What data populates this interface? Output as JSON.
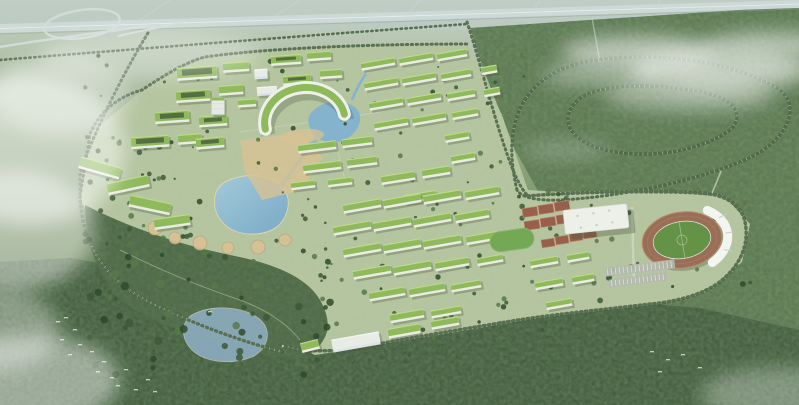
{
  "meta": {
    "image_type": "aerial architectural rendering",
    "scene": "bird's-eye master plan of a green university campus with green-roof building clusters, lakes and canal, a stadium with running track, gymnasium, tennis courts, an elevated highway with interchange at top, tree-lined loop roads in surrounding forest, mist and flying birds"
  },
  "palette": {
    "haze_top": "#c6d2c8",
    "plain": "#a9bba0",
    "forest_dark": "#415a3a",
    "forest_mid": "#6f8c60",
    "park": "#4c6742",
    "campus_ground": "#b5c3a0",
    "road": "#cfd8c4",
    "highway": "#ccd9d7",
    "highway_median": "#eaf1ee",
    "tree_dark": "#3d5837",
    "tree_mid": "#567849",
    "roof_green": "#8fba5c",
    "roof_light": "#c5dd90",
    "facade": "#eaece1",
    "facade_shadow": "#4a5a3e",
    "courtyard": "#49603c",
    "white_glass": "#dce4e6",
    "water": "#83b3cd",
    "water_light": "#a3c9dc",
    "pond": "#8aa9ba",
    "plaza_tan": "#d8c294",
    "court_red": "#96604c",
    "lawn": "#74a854",
    "track": "#9a6f58",
    "pitch": "#649348",
    "stand_white": "#f3f5f0",
    "gym_roof": "#edefe9",
    "parking": "#b4b9ae",
    "cloud": "#ffffff"
  },
  "buildings": {
    "slabs": [
      [
        197,
        73,
        40,
        13,
        -4,
        "gc"
      ],
      [
        236,
        67,
        26,
        10,
        -4,
        "g"
      ],
      [
        193,
        96,
        34,
        12,
        -4,
        "gc"
      ],
      [
        231,
        90,
        24,
        10,
        -4,
        "g"
      ],
      [
        172,
        117,
        34,
        12,
        -4,
        "gc"
      ],
      [
        213,
        121,
        28,
        11,
        -4,
        "gc"
      ],
      [
        218,
        106,
        13,
        17,
        0,
        "t"
      ],
      [
        247,
        103,
        18,
        8,
        -4,
        "g"
      ],
      [
        286,
        60,
        30,
        10,
        -4,
        "gc"
      ],
      [
        319,
        56,
        24,
        9,
        -4,
        "g"
      ],
      [
        297,
        80,
        28,
        10,
        -4,
        "gc"
      ],
      [
        331,
        74,
        22,
        9,
        -4,
        "g"
      ],
      [
        267,
        91,
        20,
        9,
        -4,
        "w"
      ],
      [
        261,
        74,
        13,
        10,
        -3,
        "w"
      ],
      [
        378,
        64,
        34,
        8,
        -10,
        "g"
      ],
      [
        416,
        59,
        34,
        8,
        -10,
        "g"
      ],
      [
        452,
        55,
        30,
        8,
        -10,
        "g"
      ],
      [
        381,
        84,
        34,
        8,
        -10,
        "g"
      ],
      [
        419,
        79,
        34,
        8,
        -10,
        "g"
      ],
      [
        456,
        75,
        30,
        8,
        -10,
        "g"
      ],
      [
        386,
        104,
        34,
        8,
        -10,
        "g"
      ],
      [
        424,
        99,
        34,
        8,
        -10,
        "g"
      ],
      [
        461,
        95,
        28,
        8,
        -10,
        "g"
      ],
      [
        391,
        124,
        34,
        8,
        -10,
        "g"
      ],
      [
        429,
        119,
        34,
        8,
        -10,
        "g"
      ],
      [
        465,
        114,
        26,
        8,
        -10,
        "g"
      ],
      [
        489,
        70,
        16,
        8,
        -10,
        "g"
      ],
      [
        492,
        92,
        16,
        8,
        -10,
        "g"
      ],
      [
        457,
        137,
        24,
        8,
        -10,
        "g"
      ],
      [
        463,
        158,
        24,
        8,
        -10,
        "g"
      ],
      [
        317,
        147,
        38,
        9,
        -7,
        "g"
      ],
      [
        357,
        142,
        30,
        9,
        -7,
        "g"
      ],
      [
        322,
        167,
        38,
        9,
        -7,
        "g"
      ],
      [
        362,
        162,
        30,
        9,
        -7,
        "g"
      ],
      [
        303,
        185,
        24,
        8,
        -7,
        "g"
      ],
      [
        340,
        182,
        24,
        8,
        -7,
        "g"
      ],
      [
        398,
        178,
        34,
        9,
        -9,
        "g"
      ],
      [
        436,
        172,
        28,
        9,
        -9,
        "g"
      ],
      [
        420,
        197,
        32,
        9,
        -9,
        "g"
      ],
      [
        100,
        168,
        42,
        12,
        16,
        "g"
      ],
      [
        128,
        185,
        42,
        12,
        -12,
        "g"
      ],
      [
        150,
        205,
        42,
        12,
        12,
        "g"
      ],
      [
        172,
        222,
        36,
        11,
        -8,
        "g"
      ],
      [
        150,
        142,
        38,
        12,
        -4,
        "gc"
      ],
      [
        190,
        139,
        24,
        10,
        -4,
        "g"
      ],
      [
        210,
        143,
        28,
        11,
        -5,
        "gc"
      ],
      [
        362,
        206,
        38,
        9,
        -10,
        "g"
      ],
      [
        402,
        201,
        38,
        9,
        -10,
        "g"
      ],
      [
        442,
        197,
        38,
        9,
        -10,
        "g"
      ],
      [
        482,
        193,
        34,
        9,
        -10,
        "g"
      ],
      [
        352,
        228,
        38,
        9,
        -10,
        "g"
      ],
      [
        392,
        224,
        38,
        9,
        -10,
        "g"
      ],
      [
        432,
        220,
        38,
        9,
        -10,
        "g"
      ],
      [
        472,
        216,
        34,
        9,
        -10,
        "g"
      ],
      [
        362,
        250,
        38,
        9,
        -10,
        "g"
      ],
      [
        402,
        246,
        38,
        9,
        -10,
        "g"
      ],
      [
        442,
        242,
        38,
        9,
        -10,
        "g"
      ],
      [
        482,
        238,
        32,
        9,
        -10,
        "g"
      ],
      [
        372,
        272,
        38,
        9,
        -10,
        "g"
      ],
      [
        412,
        268,
        38,
        9,
        -10,
        "g"
      ],
      [
        452,
        264,
        34,
        9,
        -10,
        "g"
      ],
      [
        490,
        260,
        26,
        8,
        -10,
        "g"
      ],
      [
        387,
        294,
        36,
        9,
        -10,
        "g"
      ],
      [
        427,
        290,
        36,
        9,
        -10,
        "g"
      ],
      [
        466,
        286,
        30,
        8,
        -10,
        "g"
      ],
      [
        407,
        316,
        34,
        9,
        -10,
        "g"
      ],
      [
        446,
        312,
        30,
        8,
        -10,
        "g"
      ],
      [
        544,
        262,
        28,
        8,
        -10,
        "g"
      ],
      [
        578,
        257,
        22,
        8,
        -10,
        "g"
      ],
      [
        549,
        284,
        28,
        8,
        -10,
        "g"
      ],
      [
        583,
        279,
        22,
        8,
        -10,
        "g"
      ],
      [
        559,
        304,
        26,
        8,
        -10,
        "g"
      ],
      [
        356,
        342,
        48,
        13,
        -10,
        "w"
      ],
      [
        404,
        331,
        32,
        10,
        -10,
        "g"
      ],
      [
        445,
        323,
        28,
        9,
        -10,
        "g"
      ],
      [
        310,
        346,
        18,
        10,
        -14,
        "g"
      ]
    ]
  },
  "sports": {
    "courts_group1": {
      "rot": -8,
      "cell_w": 15,
      "cell_h": 9,
      "cells": [
        [
          530,
          212
        ],
        [
          546,
          209
        ],
        [
          562,
          206
        ],
        [
          532,
          225
        ],
        [
          548,
          222
        ],
        [
          564,
          219
        ]
      ]
    },
    "courts_group2": {
      "rot": -8,
      "cell_w": 13,
      "cell_h": 8,
      "cells": [
        [
          548,
          243
        ],
        [
          562,
          240
        ],
        [
          576,
          237
        ],
        [
          590,
          234
        ]
      ]
    },
    "parking_rows": [
      [
        640,
        268,
        70,
        9,
        -7
      ],
      [
        638,
        280,
        58,
        8,
        -7
      ]
    ]
  },
  "plaza_circles": [
    [
      155,
      228,
      7
    ],
    [
      175,
      238,
      6
    ],
    [
      200,
      243,
      7
    ],
    [
      228,
      248,
      6
    ],
    [
      258,
      247,
      7
    ],
    [
      285,
      240,
      6
    ]
  ],
  "trees": {
    "seed": 7,
    "colors": [
      "#3d5837",
      "#567849",
      "#2f4a2c"
    ],
    "regions": [
      {
        "x": 85,
        "y": 45,
        "w": 440,
        "h": 150,
        "n": 60,
        "rmin": 1,
        "rmax": 2.6
      },
      {
        "x": 300,
        "y": 190,
        "w": 260,
        "h": 150,
        "n": 55,
        "rmin": 1.2,
        "rmax": 2.8
      },
      {
        "x": 88,
        "y": 235,
        "w": 250,
        "h": 140,
        "n": 70,
        "rmin": 2,
        "rmax": 4.2
      },
      {
        "x": 520,
        "y": 190,
        "w": 240,
        "h": 120,
        "n": 40,
        "rmin": 1.5,
        "rmax": 3.2
      },
      {
        "x": 80,
        "y": 130,
        "w": 130,
        "h": 120,
        "n": 30,
        "rmin": 1.5,
        "rmax": 3
      }
    ]
  },
  "birds": [
    [
      58,
      322
    ],
    [
      66,
      318
    ],
    [
      75,
      330
    ],
    [
      62,
      340
    ],
    [
      80,
      345
    ],
    [
      70,
      355
    ],
    [
      92,
      352
    ],
    [
      104,
      362
    ],
    [
      98,
      372
    ],
    [
      112,
      378
    ],
    [
      126,
      370
    ],
    [
      118,
      386
    ],
    [
      136,
      390
    ],
    [
      148,
      380
    ],
    [
      155,
      392
    ],
    [
      210,
      312
    ],
    [
      652,
      352
    ],
    [
      668,
      360
    ],
    [
      683,
      355
    ],
    [
      700,
      368
    ],
    [
      660,
      372
    ]
  ],
  "clouds": [
    [
      640,
      52,
      80,
      16,
      0.55
    ],
    [
      720,
      70,
      90,
      20,
      0.6
    ],
    [
      775,
      45,
      70,
      14,
      0.5
    ],
    [
      690,
      95,
      85,
      16,
      0.4
    ],
    [
      600,
      75,
      60,
      12,
      0.35
    ],
    [
      30,
      150,
      95,
      75,
      0.5
    ],
    [
      15,
      230,
      80,
      60,
      0.45
    ],
    [
      60,
      95,
      70,
      40,
      0.35
    ],
    [
      150,
      55,
      110,
      25,
      0.3
    ],
    [
      30,
      380,
      90,
      45,
      0.45
    ],
    [
      0,
      330,
      60,
      40,
      0.35
    ],
    [
      780,
      395,
      80,
      28,
      0.3
    ],
    [
      565,
      150,
      45,
      9,
      0.22
    ]
  ]
}
